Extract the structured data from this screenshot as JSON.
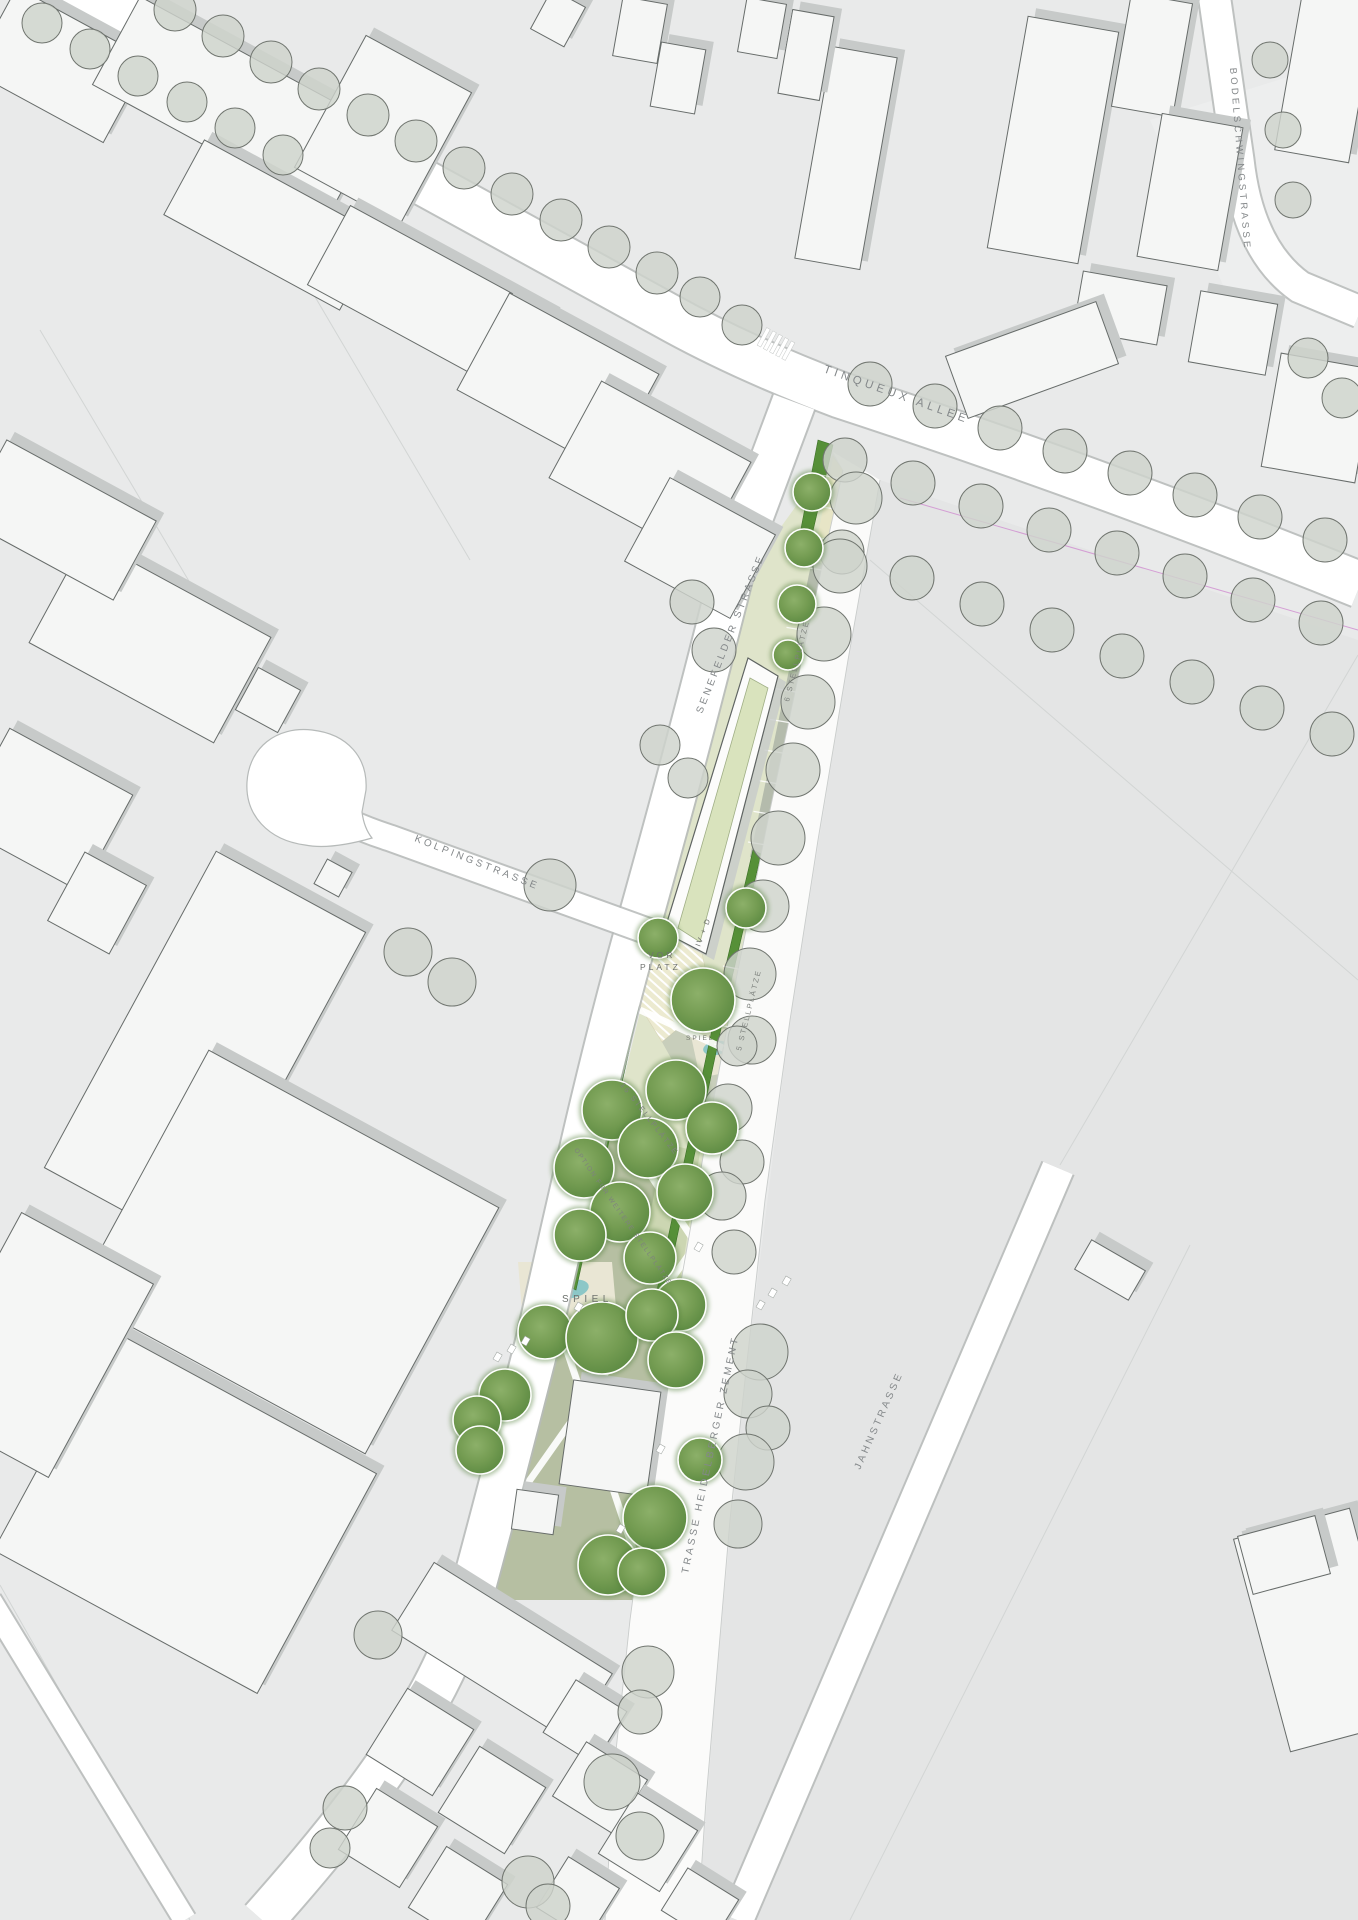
{
  "plan": {
    "streets": {
      "tinqueux_allee": "TINQUEUX ALLEE",
      "bodelschwingstrasse": "BODELSCHWINGSTRASSE",
      "senefelder_strasse": "SENEFELDER STRASSE",
      "kolpingstrasse": "KOLPINGSTRASSE",
      "trasse_heidelberger_zement": "TRASSE HEIDELBERGER ZEMENT",
      "jahnstrasse": "JAHNSTRASSE"
    },
    "site_labels": {
      "vorplatz_line1": "VOR",
      "vorplatz_line2": "PLATZ",
      "building_storeys": "IV + D",
      "spiel_small": "SPIEL",
      "spiel_meadow": "SPIEL",
      "stellplaetze_6": "6 STELLPLÄTZE",
      "stellplaetze_5": "5 STELLPLÄTZE",
      "stellplaetze_16": "16 STELLPLÄTZE",
      "option_weitere_stellplaetze": "OPTION FÜR WEITERE STELLPLÄTZE"
    },
    "colors": {
      "background": "#e9eaea",
      "field": "#e4e5e5",
      "street": "#ffffff",
      "corridor": "#fbfbfa",
      "building_fill": "#f5f6f5",
      "building_outline": "#676c6a",
      "shadow": "#c7cac9",
      "existing_tree": "#ced3cc",
      "new_tree": "#6f9b50",
      "hedge": "#569038",
      "lawn_light": "#dfe4ca",
      "lawn_mid": "#c9d3ae",
      "meadow": "#b6bfa2",
      "plaza": "#ecead0",
      "parking_base": "#e7e5c6",
      "aisle": "#b4bbac",
      "sand": "#e9e6d4",
      "water": "#8cc7c7",
      "label": "#84888a",
      "utility_line": "#cf8ccf"
    }
  }
}
